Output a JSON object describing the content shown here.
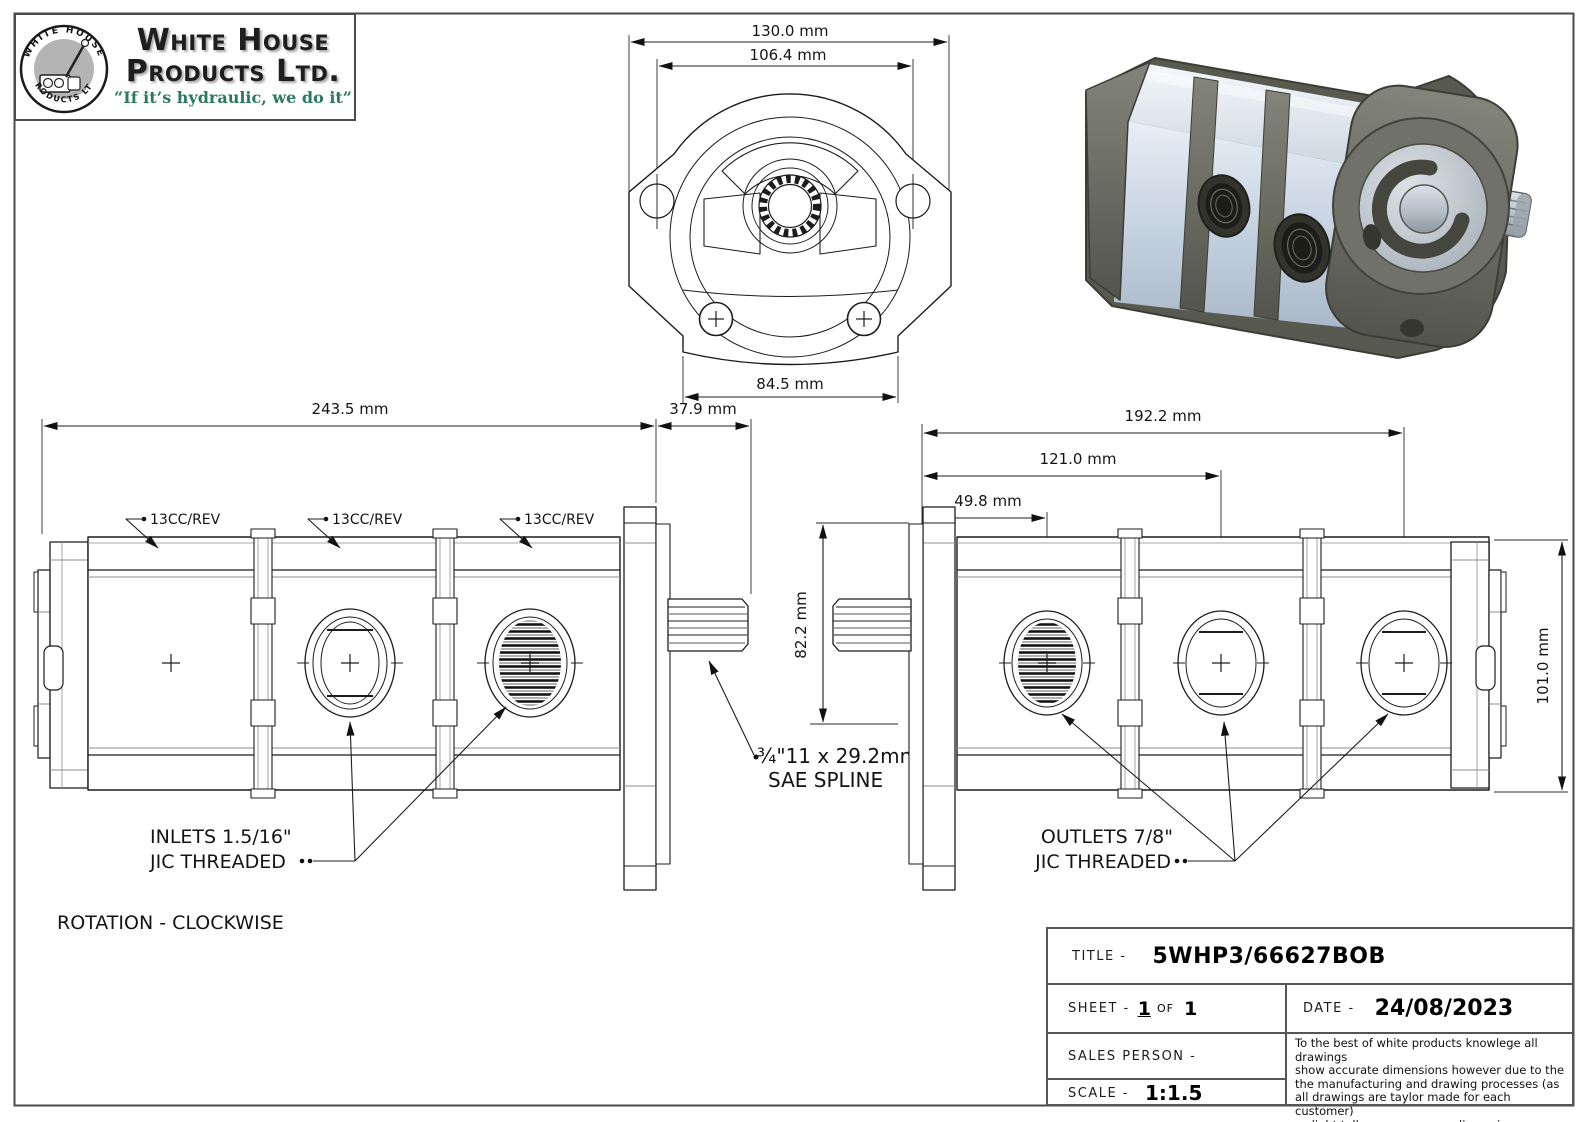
{
  "logo": {
    "badge_top": "WHITE HOUSE",
    "badge_bottom": "PRODUCTS LTD",
    "company_line1": "White House",
    "company_line2": "Products Ltd.",
    "tagline": "“If it’s hydraulic, we do it”"
  },
  "front_view": {
    "dim_overall": "130.0 mm",
    "dim_holes": "106.4 mm",
    "dim_body": "84.5 mm"
  },
  "left_view": {
    "dim_length": "243.5 mm",
    "dim_shaft": "37.9 mm",
    "label1": "13CC/REV",
    "label2": "13CC/REV",
    "label3": "13CC/REV",
    "inlets1": "INLETS 1.5/16\"",
    "inlets2": "JIC THREADED"
  },
  "notes": {
    "spline1": "¾\"11 x 29.2mm",
    "spline2": "SAE SPLINE",
    "rotation": "ROTATION - CLOCKWISE"
  },
  "right_view": {
    "dim_total": "192.2 mm",
    "dim_port2": "121.0 mm",
    "dim_port1": "49.8 mm",
    "dim_height_left": "82.2 mm",
    "dim_height_right": "101.0 mm",
    "outlets1": "OUTLETS 7/8\"",
    "outlets2": "JIC THREADED"
  },
  "title_block": {
    "title_label": "TITLE -",
    "title_value": "5WHP3/66627BOB",
    "sheet_label": "SHEET -",
    "sheet_num": "1",
    "of_label": "OF",
    "sheet_total": "1",
    "date_label": "DATE -",
    "date_value": "24/08/2023",
    "sales_label": "SALES PERSON -",
    "scale_label": "SCALE -",
    "scale_value": "1:1.5",
    "disclaimer_lines": [
      "To the best of white products knowlege all drawings",
      "show accurate dimensions however due to the",
      "the manufacturing and drawing processes (as",
      "all drawings are taylor made for each customer)",
      "a slight tollerance on some dimensions may occur"
    ]
  }
}
